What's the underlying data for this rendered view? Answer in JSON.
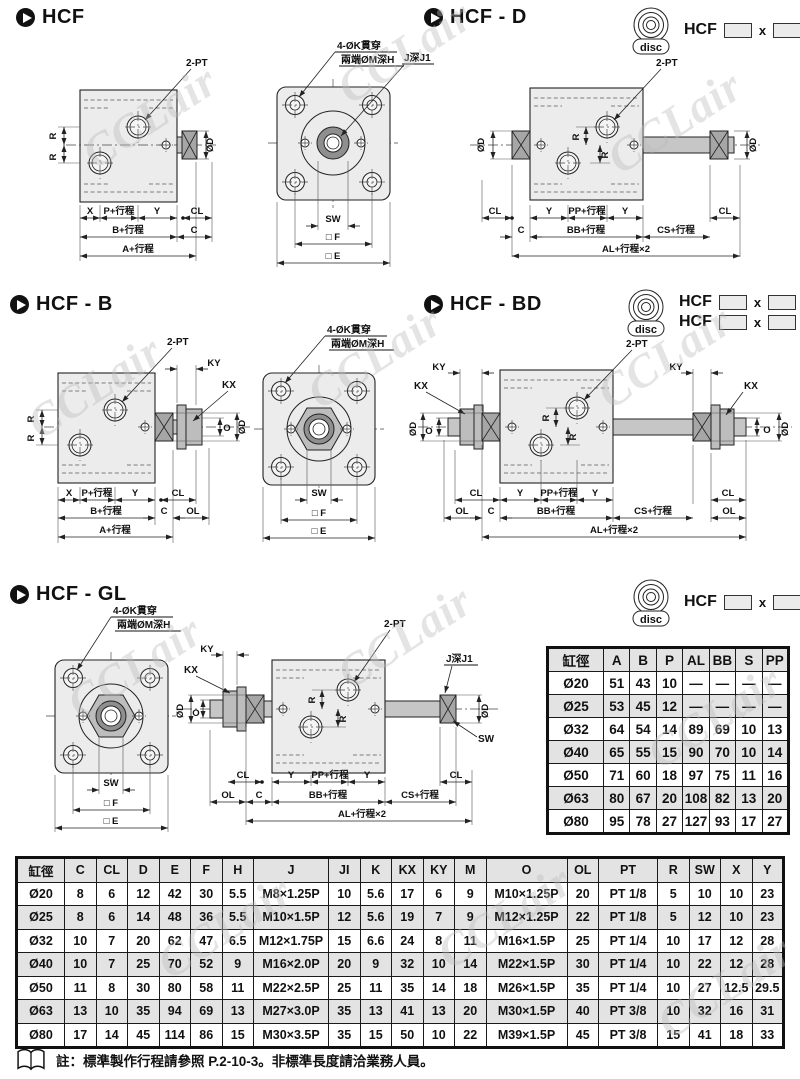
{
  "watermark": "CCLair",
  "sections": {
    "hcf": {
      "title": "HCF"
    },
    "hcfd": {
      "title": "HCF - D"
    },
    "hcfb": {
      "title": "HCF - B"
    },
    "hcfbd": {
      "title": "HCF - BD"
    },
    "hcfgl": {
      "title": "HCF - GL"
    }
  },
  "badge": {
    "brand": "HCF",
    "sep": "x",
    "disc": "disc"
  },
  "badges": {
    "st": "ST",
    "b": "B",
    "bd": "BD",
    "g": "G"
  },
  "dim": {
    "two_pt": "2-PT",
    "four_ok": "4-ØK貫穿",
    "both_m": "兩端ØM深H",
    "j_depth": "J深J1",
    "x": "X",
    "p": "P+行程",
    "y": "Y",
    "cl": "CL",
    "b": "B+行程",
    "c": "C",
    "a": "A+行程",
    "r": "R",
    "od": "ØD",
    "sw": "SW",
    "f": "□ F",
    "e": "□ E",
    "ky": "KY",
    "kx": "KX",
    "o": "O",
    "ol": "OL",
    "pp": "PP+行程",
    "bb": "BB+行程",
    "cs": "CS+行程",
    "al": "AL+行程×2"
  },
  "tables": {
    "small": {
      "headers": [
        "缸徑",
        "A",
        "B",
        "P",
        "AL",
        "BB",
        "S",
        "PP"
      ],
      "rows": [
        [
          "Ø20",
          "51",
          "43",
          "10",
          "—",
          "—",
          "—",
          "—"
        ],
        [
          "Ø25",
          "53",
          "45",
          "12",
          "—",
          "—",
          "—",
          "—"
        ],
        [
          "Ø32",
          "64",
          "54",
          "14",
          "89",
          "69",
          "10",
          "13"
        ],
        [
          "Ø40",
          "65",
          "55",
          "15",
          "90",
          "70",
          "10",
          "14"
        ],
        [
          "Ø50",
          "71",
          "60",
          "18",
          "97",
          "75",
          "11",
          "16"
        ],
        [
          "Ø63",
          "80",
          "67",
          "20",
          "108",
          "82",
          "13",
          "20"
        ],
        [
          "Ø80",
          "95",
          "78",
          "27",
          "127",
          "93",
          "17",
          "27"
        ]
      ]
    },
    "big": {
      "headers": [
        "缸徑",
        "C",
        "CL",
        "D",
        "E",
        "F",
        "H",
        "J",
        "JI",
        "K",
        "KX",
        "KY",
        "M",
        "O",
        "OL",
        "PT",
        "R",
        "SW",
        "X",
        "Y"
      ],
      "rows": [
        [
          "Ø20",
          "8",
          "6",
          "12",
          "42",
          "30",
          "5.5",
          "M8×1.25P",
          "10",
          "5.6",
          "17",
          "6",
          "9",
          "M10×1.25P",
          "20",
          "PT 1/8",
          "5",
          "10",
          "10",
          "23"
        ],
        [
          "Ø25",
          "8",
          "6",
          "14",
          "48",
          "36",
          "5.5",
          "M10×1.5P",
          "12",
          "5.6",
          "19",
          "7",
          "9",
          "M12×1.25P",
          "22",
          "PT 1/8",
          "5",
          "12",
          "10",
          "23"
        ],
        [
          "Ø32",
          "10",
          "7",
          "20",
          "62",
          "47",
          "6.5",
          "M12×1.75P",
          "15",
          "6.6",
          "24",
          "8",
          "11",
          "M16×1.5P",
          "25",
          "PT 1/4",
          "10",
          "17",
          "12",
          "28"
        ],
        [
          "Ø40",
          "10",
          "7",
          "25",
          "70",
          "52",
          "9",
          "M16×2.0P",
          "20",
          "9",
          "32",
          "10",
          "14",
          "M22×1.5P",
          "30",
          "PT 1/4",
          "10",
          "22",
          "12",
          "28"
        ],
        [
          "Ø50",
          "11",
          "8",
          "30",
          "80",
          "58",
          "11",
          "M22×2.5P",
          "25",
          "11",
          "35",
          "14",
          "18",
          "M26×1.5P",
          "35",
          "PT 1/4",
          "10",
          "27",
          "12.5",
          "29.5"
        ],
        [
          "Ø63",
          "13",
          "10",
          "35",
          "94",
          "69",
          "13",
          "M27×3.0P",
          "35",
          "13",
          "41",
          "13",
          "20",
          "M30×1.5P",
          "40",
          "PT 3/8",
          "10",
          "32",
          "16",
          "31"
        ],
        [
          "Ø80",
          "17",
          "14",
          "45",
          "114",
          "86",
          "15",
          "M30×3.5P",
          "35",
          "15",
          "50",
          "10",
          "22",
          "M39×1.5P",
          "45",
          "PT 3/8",
          "15",
          "41",
          "18",
          "33"
        ]
      ]
    }
  },
  "note": {
    "text": "註：標準製作行程請參照 P.2-10-3。非標準長度請洽業務人員。"
  }
}
